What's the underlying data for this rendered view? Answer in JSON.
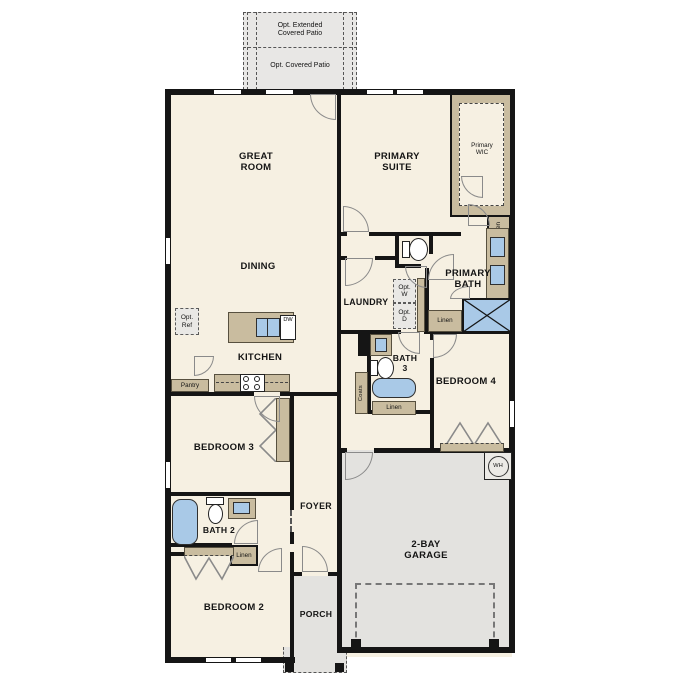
{
  "floorplan": {
    "patio": {
      "extended_label": "Opt. Extended\nCovered Patio",
      "covered_label": "Opt. Covered Patio"
    },
    "rooms": {
      "great_room": "GREAT\nROOM",
      "dining": "DINING",
      "primary_suite": "PRIMARY\nSUITE",
      "primary_wic": "Primary\nWIC",
      "primary_bath": "PRIMARY\nBATH",
      "laundry": "LAUNDRY",
      "kitchen": "KITCHEN",
      "bath3": "BATH\n3",
      "bedroom4": "BEDROOM 4",
      "bedroom3": "BEDROOM 3",
      "foyer": "FOYER",
      "bath2": "BATH 2",
      "bedroom2": "BEDROOM 2",
      "porch": "PORCH",
      "garage": "2-BAY\nGARAGE"
    },
    "closets": {
      "pantry": "Pantry",
      "coats": "Coats",
      "linen_primary_hall": "Linen",
      "linen_primary_bath": "Linen",
      "linen_bath3": "Linen",
      "linen_bath2": "Linen"
    },
    "options": {
      "refrigerator": "Opt.\nRef",
      "washer": "Opt.\nW",
      "dryer": "Opt.\nD"
    },
    "appliances": {
      "dishwasher": "DW",
      "water_heater": "WH"
    },
    "colors": {
      "floor": "#f6f0e2",
      "wall": "#151515",
      "cabinet": "#c9bc9f",
      "fixture_blue": "#a9c9e7",
      "concrete": "#e3e2df"
    }
  }
}
